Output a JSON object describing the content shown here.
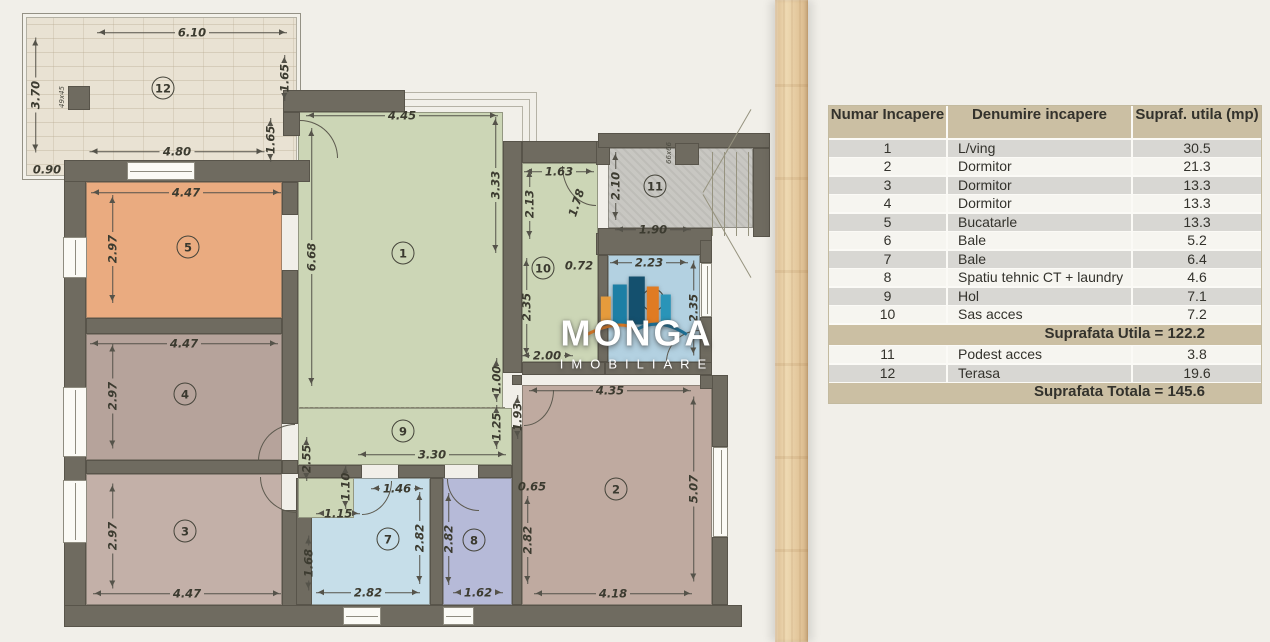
{
  "logo": {
    "name": "MONGA",
    "tagline": "IMOBILIARE"
  },
  "table": {
    "headers": [
      "Numar Incapere",
      "Denumire incapere",
      "Supraf. utila (mp)"
    ],
    "rows": [
      [
        "1",
        "L/ving",
        "30.5"
      ],
      [
        "2",
        "Dormitor",
        "21.3"
      ],
      [
        "3",
        "Dormitor",
        "13.3"
      ],
      [
        "4",
        "Dormitor",
        "13.3"
      ],
      [
        "5",
        "Bucatarle",
        "13.3"
      ],
      [
        "6",
        "Bale",
        "5.2"
      ],
      [
        "7",
        "Bale",
        "6.4"
      ],
      [
        "8",
        "Spatiu tehnic CT + laundry",
        "4.6"
      ],
      [
        "9",
        "Hol",
        "7.1"
      ],
      [
        "10",
        "Sas acces",
        "7.2"
      ]
    ],
    "subtotal": "Suprafata Utila = 122.2",
    "rows2": [
      [
        "11",
        "Podest acces",
        "3.8"
      ],
      [
        "12",
        "Terasa",
        "19.6"
      ]
    ],
    "total": "Suprafata Totala = 145.6"
  },
  "plan": {
    "room_labels": [
      {
        "n": "12",
        "x": 163,
        "y": 88
      },
      {
        "n": "5",
        "x": 188,
        "y": 247
      },
      {
        "n": "4",
        "x": 185,
        "y": 394
      },
      {
        "n": "3",
        "x": 185,
        "y": 531
      },
      {
        "n": "1",
        "x": 403,
        "y": 253
      },
      {
        "n": "9",
        "x": 403,
        "y": 431
      },
      {
        "n": "10",
        "x": 543,
        "y": 268
      },
      {
        "n": "6",
        "x": 653,
        "y": 300
      },
      {
        "n": "11",
        "x": 655,
        "y": 186
      },
      {
        "n": "2",
        "x": 616,
        "y": 489
      },
      {
        "n": "7",
        "x": 388,
        "y": 539
      },
      {
        "n": "8",
        "x": 474,
        "y": 540
      }
    ],
    "column_labels": [
      {
        "t": "49x45",
        "x": 62,
        "y": 97
      },
      {
        "t": "66x66",
        "x": 669,
        "y": 153
      }
    ],
    "dims": [
      {
        "t": "6.10",
        "x": 192,
        "y": 33,
        "o": "h",
        "l": 190
      },
      {
        "t": "3.70",
        "x": 36,
        "y": 95,
        "o": "v",
        "l": 115
      },
      {
        "t": "1.65",
        "x": 285,
        "y": 78,
        "o": "v",
        "l": 46
      },
      {
        "t": "1.65",
        "x": 271,
        "y": 142,
        "o": "v",
        "l": 40
      },
      {
        "t": "4.80",
        "x": 177,
        "y": 152,
        "o": "h",
        "l": 175
      },
      {
        "t": "0.90",
        "x": 47,
        "y": 170,
        "o": "h",
        "l": 0
      },
      {
        "t": "4.47",
        "x": 186,
        "y": 193,
        "o": "h",
        "l": 190
      },
      {
        "t": "2.97",
        "x": 113,
        "y": 249,
        "o": "v",
        "l": 108
      },
      {
        "t": "4.47",
        "x": 184,
        "y": 344,
        "o": "h",
        "l": 188
      },
      {
        "t": "2.97",
        "x": 113,
        "y": 396,
        "o": "v",
        "l": 105
      },
      {
        "t": "2.97",
        "x": 113,
        "y": 536,
        "o": "v",
        "l": 105
      },
      {
        "t": "4.47",
        "x": 187,
        "y": 594,
        "o": "h",
        "l": 188
      },
      {
        "t": "4.45",
        "x": 402,
        "y": 116,
        "o": "h",
        "l": 192
      },
      {
        "t": "3.33",
        "x": 496,
        "y": 185,
        "o": "v",
        "l": 136
      },
      {
        "t": "6.68",
        "x": 312,
        "y": 257,
        "o": "v",
        "l": 258
      },
      {
        "t": "1.63",
        "x": 559,
        "y": 172,
        "o": "h",
        "l": 70
      },
      {
        "t": "2.13",
        "x": 530,
        "y": 204,
        "o": "v",
        "l": 70
      },
      {
        "t": "1.78",
        "x": 577,
        "y": 203,
        "o": "h",
        "l": 0,
        "r": -72
      },
      {
        "t": "0.72",
        "x": 579,
        "y": 266,
        "o": "h",
        "l": 0
      },
      {
        "t": "2.35",
        "x": 527,
        "y": 307,
        "o": "v",
        "l": 98
      },
      {
        "t": "2.23",
        "x": 649,
        "y": 263,
        "o": "h",
        "l": 78
      },
      {
        "t": "2.35",
        "x": 694,
        "y": 308,
        "o": "v",
        "l": 95
      },
      {
        "t": "2.00",
        "x": 547,
        "y": 356,
        "o": "h",
        "l": 52
      },
      {
        "t": "2.10",
        "x": 616,
        "y": 186,
        "o": "v",
        "l": 68
      },
      {
        "t": "1.90",
        "x": 653,
        "y": 230,
        "o": "h",
        "l": 76
      },
      {
        "t": "1.00",
        "x": 497,
        "y": 389,
        "o": "v",
        "l": 26
      },
      {
        "t": "1.25",
        "x": 497,
        "y": 434,
        "o": "v",
        "l": 30
      },
      {
        "t": "1.93",
        "x": 518,
        "y": 417,
        "o": "v",
        "l": 44
      },
      {
        "t": "3.30",
        "x": 432,
        "y": 455,
        "o": "h",
        "l": 148
      },
      {
        "t": "2.55",
        "x": 307,
        "y": 461,
        "o": "v",
        "l": 40
      },
      {
        "t": "1.15",
        "x": 327,
        "y": 514,
        "o": "h",
        "l": 22
      },
      {
        "t": "1.10",
        "x": 346,
        "y": 496,
        "o": "v",
        "l": 26
      },
      {
        "t": "1.46",
        "x": 397,
        "y": 489,
        "o": "h",
        "l": 52
      },
      {
        "t": "2.82",
        "x": 420,
        "y": 538,
        "o": "v",
        "l": 92
      },
      {
        "t": "1.68",
        "x": 309,
        "y": 563,
        "o": "v",
        "l": 55
      },
      {
        "t": "2.82",
        "x": 368,
        "y": 593,
        "o": "h",
        "l": 104
      },
      {
        "t": "2.82",
        "x": 449,
        "y": 539,
        "o": "v",
        "l": 92
      },
      {
        "t": "1.62",
        "x": 478,
        "y": 593,
        "o": "h",
        "l": 50
      },
      {
        "t": "4.35",
        "x": 610,
        "y": 391,
        "o": "h",
        "l": 162
      },
      {
        "t": "0.65",
        "x": 532,
        "y": 487,
        "o": "h",
        "l": 0
      },
      {
        "t": "2.82",
        "x": 528,
        "y": 540,
        "o": "v",
        "l": 88
      },
      {
        "t": "5.07",
        "x": 694,
        "y": 489,
        "o": "v",
        "l": 185
      },
      {
        "t": "4.18",
        "x": 613,
        "y": 594,
        "o": "h",
        "l": 158
      }
    ]
  }
}
